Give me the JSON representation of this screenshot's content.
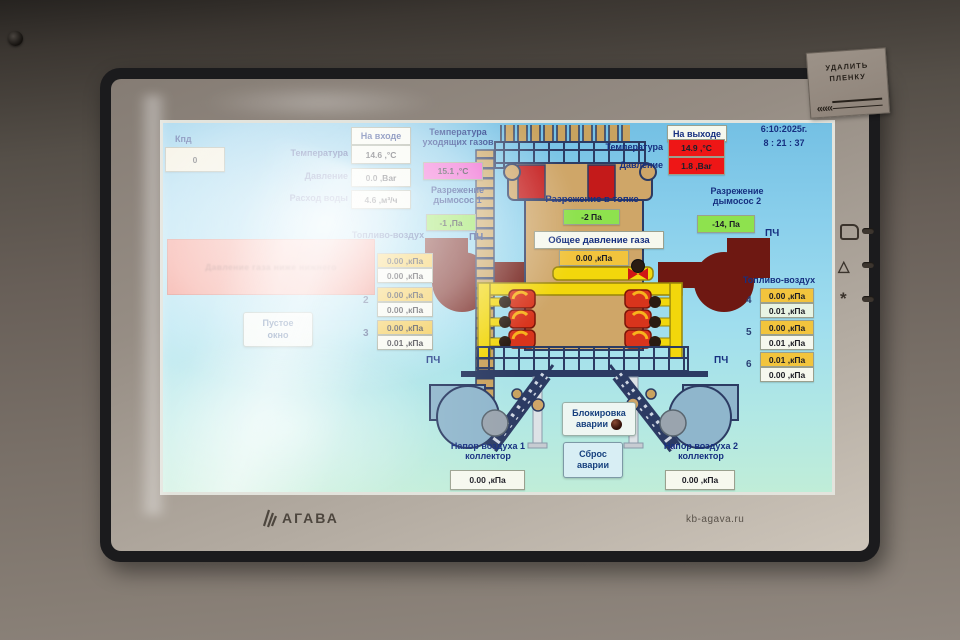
{
  "screen": {
    "clock": {
      "date": "6:10:2025г.",
      "time": "8 : 21 : 37"
    },
    "efficiency": {
      "label": "Кпд",
      "value": "0"
    },
    "inlet": {
      "title": "На входе",
      "rows": [
        {
          "label": "Температура",
          "value": "14.6 ,°C"
        },
        {
          "label": "Давление",
          "value": "0.0 ,Bar"
        },
        {
          "label": "Расход воды",
          "value": "4.6 ,м³/ч"
        }
      ]
    },
    "outlet": {
      "title": "На выходе",
      "rows": [
        {
          "label": "Температура",
          "value": "14.9 ,°C"
        },
        {
          "label": "Давление",
          "value": "1.8 ,Bar"
        }
      ]
    },
    "flue_gas": {
      "line1": "Температура",
      "line2": "уходящих газов",
      "value": "15.1 ,°C"
    },
    "draft_fan1": {
      "line1": "Разрежение",
      "line2": "дымосос 1",
      "value": "-1 ,Па"
    },
    "draft_fan2": {
      "line1": "Разрежение",
      "line2": "дымосос 2",
      "value": "-14, Па"
    },
    "furnace_draft": {
      "label": "Разрежение в топке",
      "value": "-2 Па"
    },
    "gas_pressure": {
      "label": "Общее давление газа",
      "value": "0.00 ,кПа"
    },
    "alarm_banner": {
      "text": "Давление газа ниже нижнего"
    },
    "empty_window": {
      "line1": "Пустое",
      "line2": "окно"
    },
    "vfd_label": "ПЧ",
    "fuel_air_left": {
      "title": "Топливо-воздух",
      "pairs": [
        {
          "num": "",
          "top": "0.00 ,кПа",
          "bottom": "0.00 ,кПа"
        },
        {
          "num": "2",
          "top": "0.00 ,кПа",
          "bottom": "0.00 ,кПа"
        },
        {
          "num": "3",
          "top": "0.00 ,кПа",
          "bottom": "0.01 ,кПа"
        }
      ]
    },
    "fuel_air_right": {
      "title": "Топливо-воздух",
      "pairs": [
        {
          "num": "4",
          "top": "0.00 ,кПа",
          "bottom": "0.01 ,кПа"
        },
        {
          "num": "5",
          "top": "0.00 ,кПа",
          "bottom": "0.01 ,кПа"
        },
        {
          "num": "6",
          "top": "0.01 ,кПа",
          "bottom": "0.00 ,кПа"
        }
      ]
    },
    "air_collector1": {
      "line1": "Напор воздуха 1",
      "line2": "коллектор",
      "value": "0.00 ,кПа"
    },
    "air_collector2": {
      "line1": "Напор воздуха 2",
      "line2": "коллектор",
      "value": "0.00 ,кПа"
    },
    "alarm_block": {
      "line1": "Блокировка",
      "line2": "аварии"
    },
    "alarm_reset": {
      "line1": "Сброс",
      "line2": "аварии"
    }
  },
  "bezel": {
    "brand": "АГАВА",
    "website": "kb-agava.ru",
    "sticker_line1": "УДАЛИТЬ",
    "sticker_line2": "ПЛЕНКУ",
    "sticker_arrows": "«««"
  },
  "colors": {
    "accent_blue": "#162f80",
    "alarm_red": "#ee1616",
    "ok_green": "#8ee24e",
    "warn_yellow": "#f2c43d",
    "magenta": "#ee55cc",
    "screen_bg": "#8bd0ec"
  }
}
